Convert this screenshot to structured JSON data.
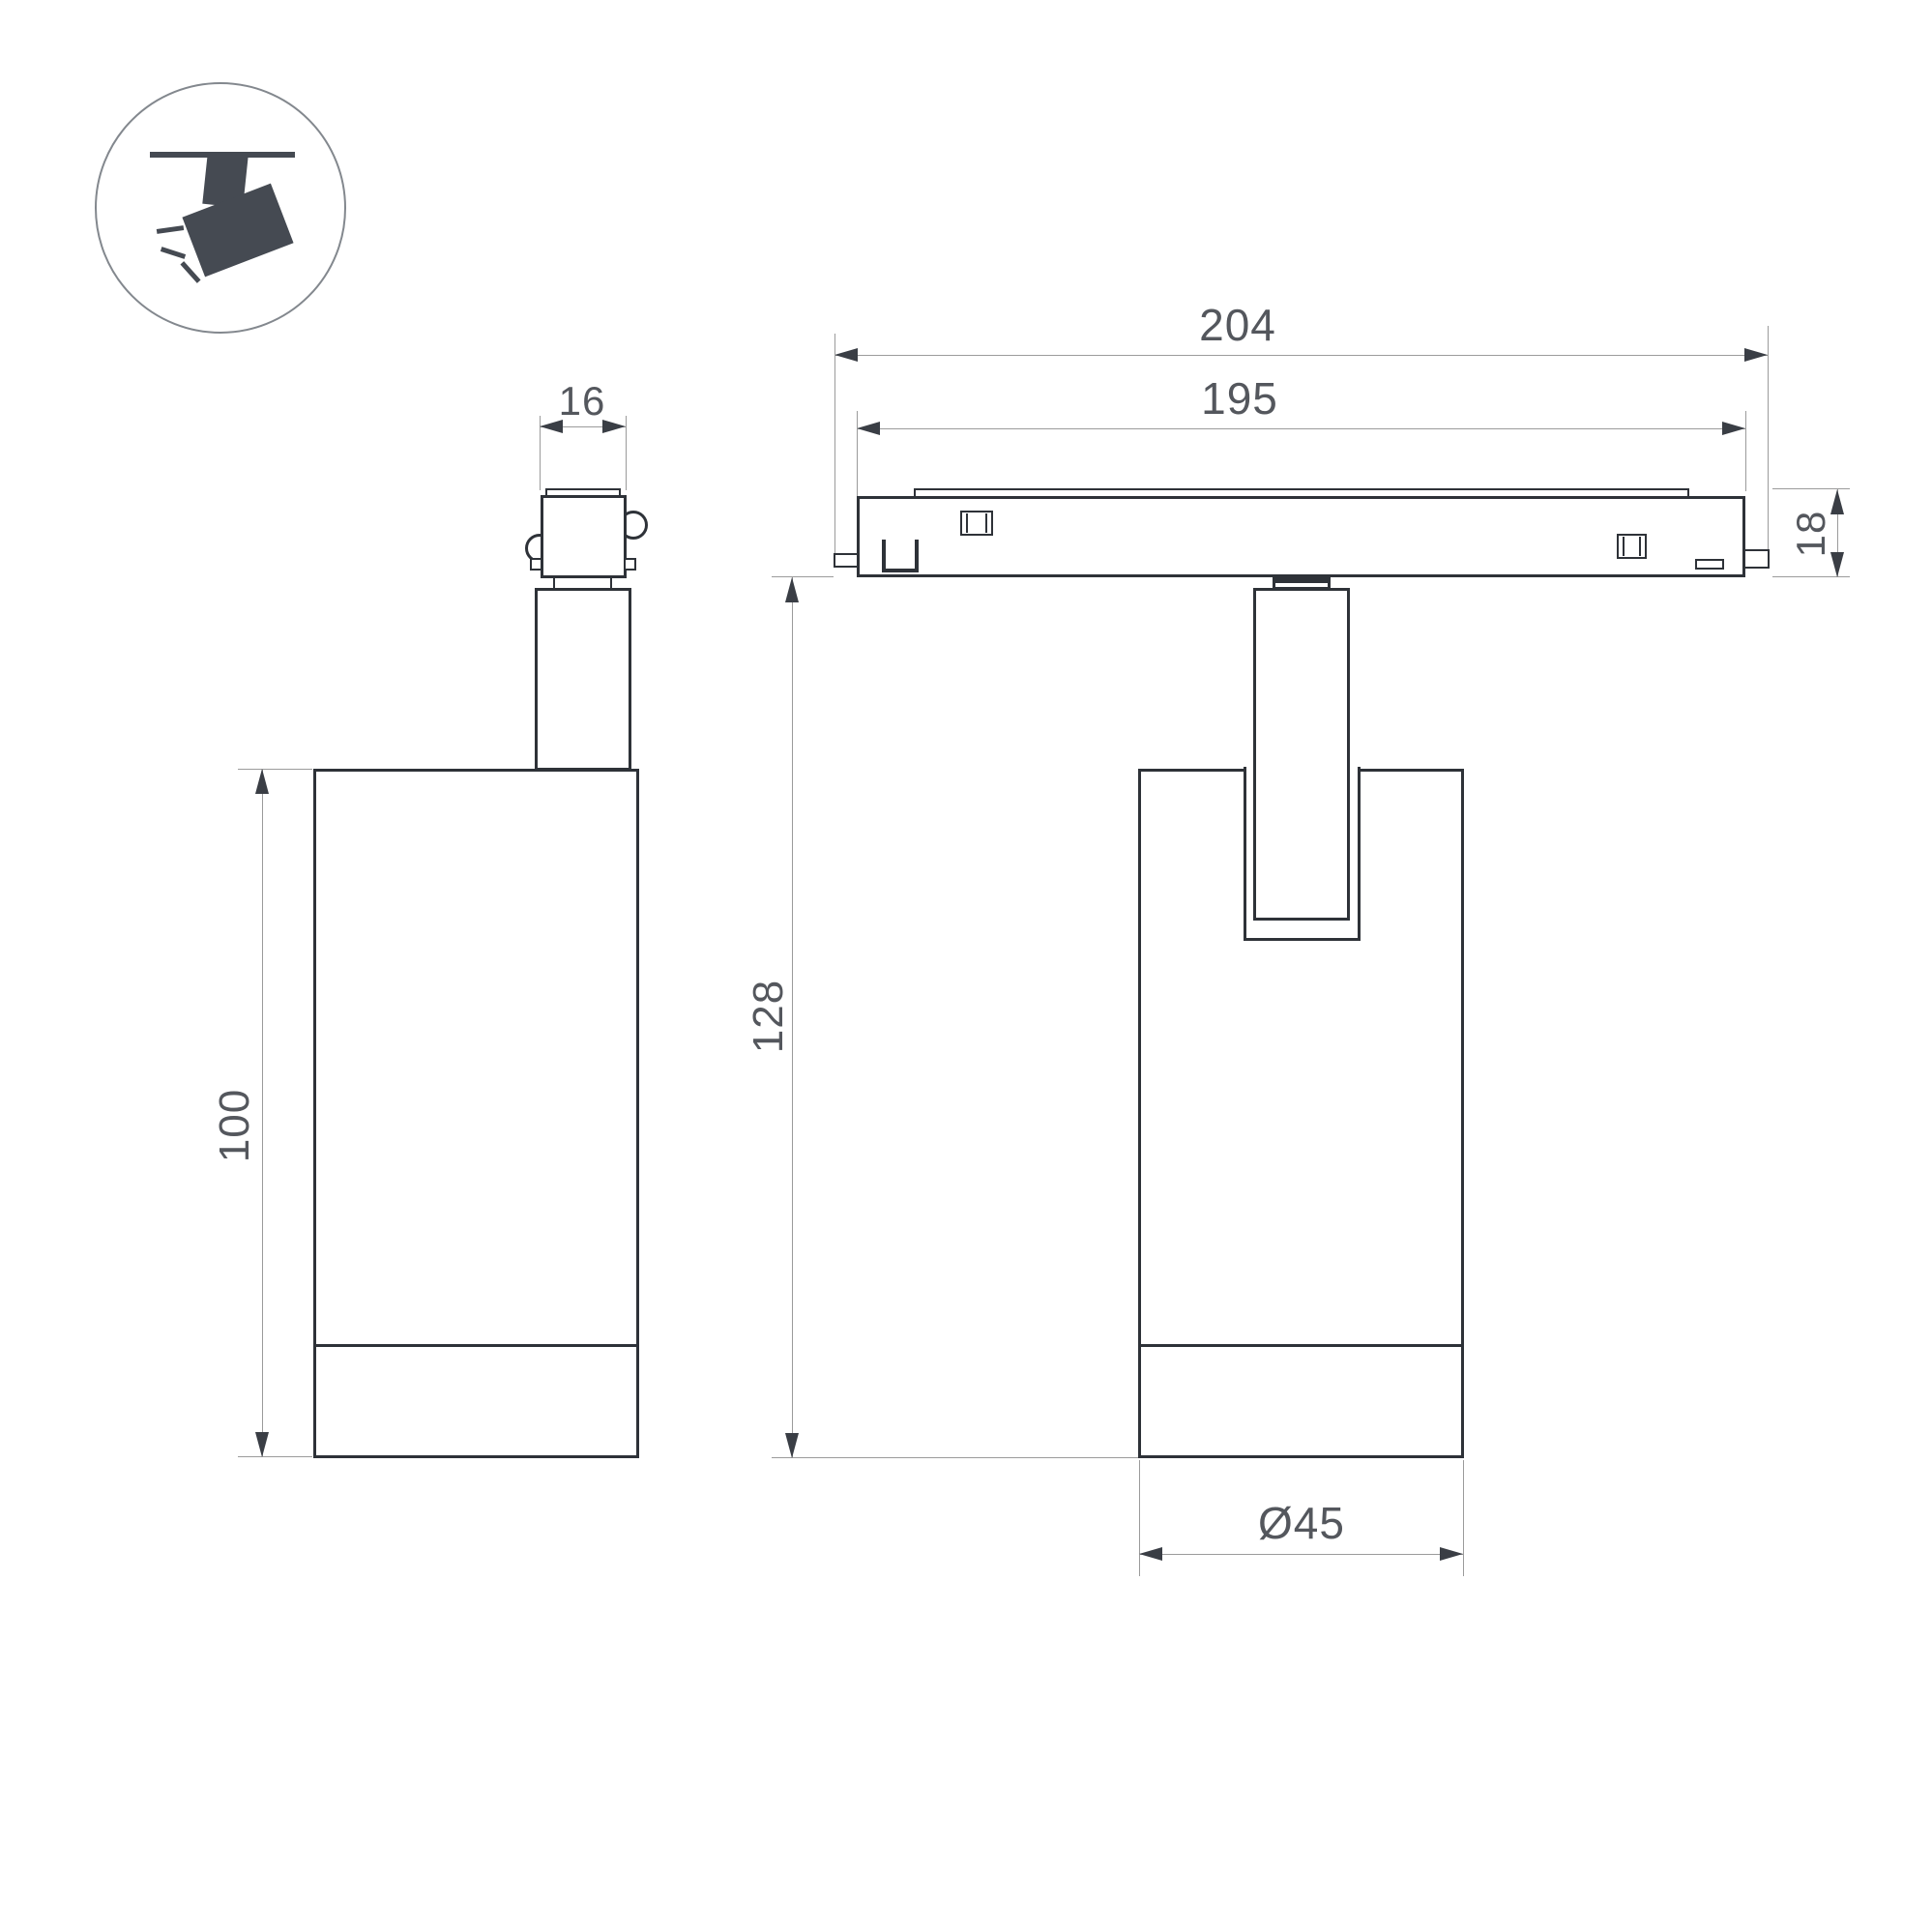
{
  "drawing": {
    "icon": "track-spotlight-icon",
    "colors": {
      "line": "#2e3238",
      "dimension_line": "#9b9b9b",
      "arrow": "#3a3e45",
      "text": "#54575d",
      "icon": "#454a52",
      "background": "#ffffff"
    },
    "dimensions": {
      "adapter_width": {
        "value": "16"
      },
      "body_height": {
        "value": "100"
      },
      "track_length_outer": {
        "value": "204"
      },
      "track_length_inner": {
        "value": "195"
      },
      "track_height": {
        "value": "18"
      },
      "total_height": {
        "value": "128"
      },
      "body_diameter": {
        "value": "Ø45"
      }
    }
  }
}
